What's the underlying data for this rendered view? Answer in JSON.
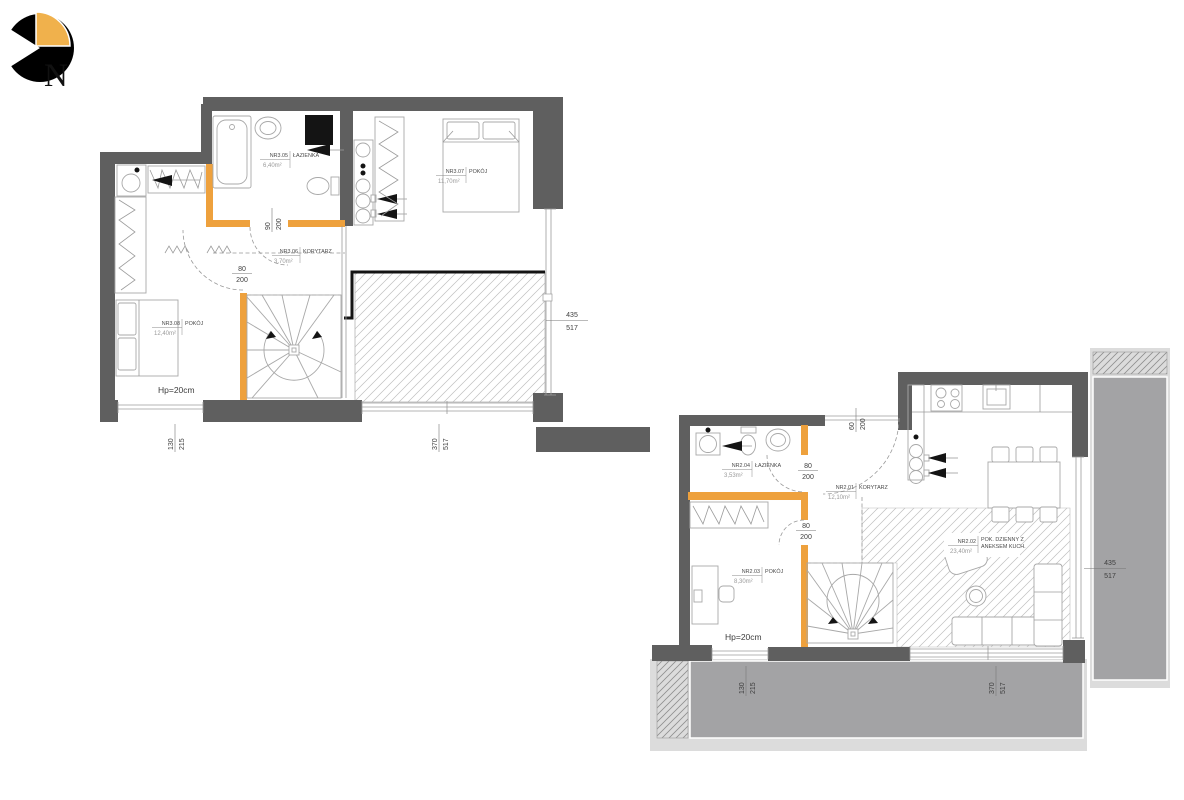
{
  "logo": {
    "letter": "N"
  },
  "palette": {
    "wall": "#5f5f5f",
    "accent": "#eea13d",
    "balcony": "#a3a3a5",
    "balcony_light": "#dcdcdc"
  },
  "upper_plan": {
    "parapet_note": "Hp=20cm",
    "rooms": [
      {
        "number": "NR3.05",
        "name": "ŁAZIENKA",
        "area": "6,40m²"
      },
      {
        "number": "NR3.06",
        "name": "KORYTARZ",
        "area": "3,70m²"
      },
      {
        "number": "NR3.07",
        "name": "POKÓJ",
        "area": "11,70m²"
      },
      {
        "number": "NR3.08",
        "name": "POKÓJ",
        "area": "12,40m²"
      }
    ],
    "door_dims": [
      {
        "w": "90",
        "h": "200"
      },
      {
        "w": "80",
        "h": "200"
      }
    ],
    "window_dims": [
      {
        "w": "130",
        "h": "215"
      },
      {
        "w": "370",
        "h": "517"
      },
      {
        "w": "435",
        "h": "517"
      }
    ]
  },
  "lower_plan": {
    "parapet_note": "Hp=20cm",
    "rooms": [
      {
        "number": "NR2.04",
        "name": "ŁAZIENKA",
        "area": "3,53m²"
      },
      {
        "number": "NR2.01",
        "name": "KORYTARZ",
        "area": "12,10m²"
      },
      {
        "number": "NR2.02",
        "name_line1": "POK. DZIENNY Z",
        "name_line2": "ANEKSEM KUCH.",
        "area": "23,40m²"
      },
      {
        "number": "NR2.03",
        "name": "POKÓJ",
        "area": "8,30m²"
      }
    ],
    "door_dims": [
      {
        "w": "80",
        "h": "200"
      },
      {
        "w": "80",
        "h": "200"
      },
      {
        "w": "60",
        "h": "200"
      }
    ],
    "window_dims": [
      {
        "w": "130",
        "h": "215"
      },
      {
        "w": "370",
        "h": "517"
      },
      {
        "w": "435",
        "h": "517"
      }
    ]
  }
}
